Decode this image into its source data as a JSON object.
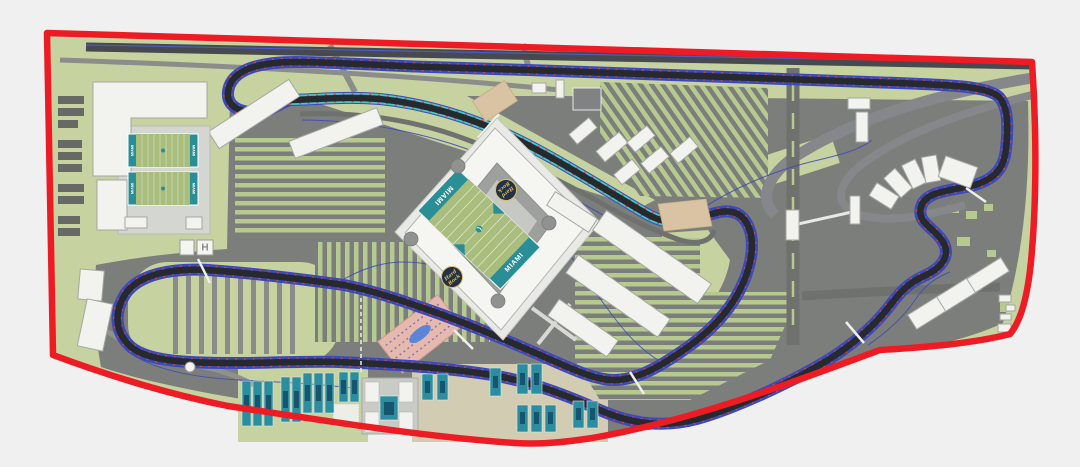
{
  "canvas": {
    "width": 1080,
    "height": 467
  },
  "colors": {
    "background": "#f0f0f1",
    "boundary_red": "#ed1c24",
    "grass_green": "#c6d2a0",
    "asphalt_gray": "#7c7e7b",
    "highway_dark": "#46494d",
    "track_dark": "#26292e",
    "barrier_blue": "#3d49bb",
    "pit_teal": "#45c8cc",
    "curb_red": "#d84a33",
    "building_white": "#f2f2ef",
    "field_teal": "#2a8e96",
    "turf_green": "#a9bd7d",
    "court_teal": "#2b8da0",
    "court_inner_blue": "#17546d",
    "plaza_pink": "#e5b9ae",
    "pond_blue": "#5b86d8",
    "paddock_tan": "#d9c3a2"
  },
  "stadium": {
    "end_zone_label": "MIAMI",
    "logo_word1": "Hard",
    "logo_word2": "Rock"
  },
  "practice_fields": {
    "end_zone_label": "MIAMI"
  },
  "helipad": {
    "label": "H"
  }
}
